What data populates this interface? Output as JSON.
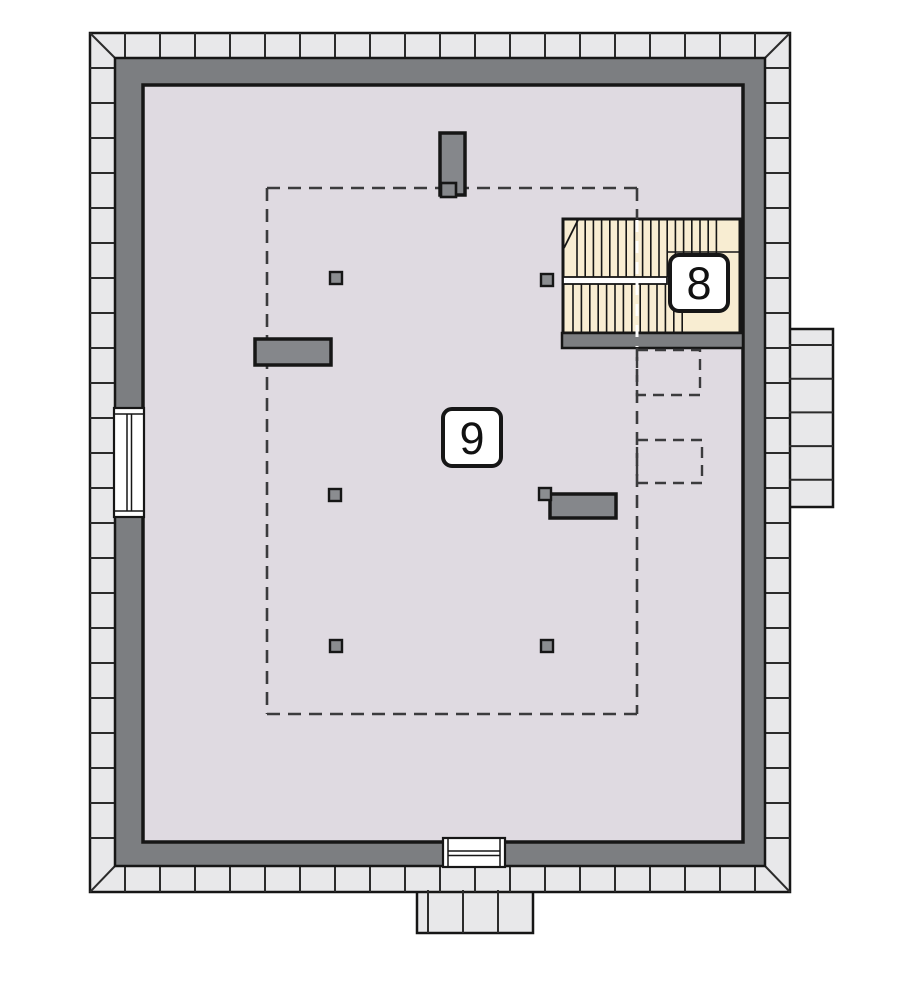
{
  "document": {
    "type": "architectural-floor-plan",
    "visible_text": [
      "9",
      "8"
    ]
  },
  "rooms": [
    {
      "number": "9",
      "area": "attic-main-room"
    },
    {
      "number": "8",
      "area": "staircase"
    }
  ],
  "colors": {
    "background": "#ffffff",
    "tile": "#e8e8ea",
    "wall": "#7c7e81",
    "floor": "#dfdae1",
    "stair": "#f8edd2",
    "chimney": "#85878b",
    "post": "#8b8d90",
    "line": "#161616",
    "tileline": "#2b2b2b",
    "dash": "#3b3b3d",
    "white": "#ffffff"
  },
  "plan": {
    "canvas": {
      "w": 900,
      "h": 999
    },
    "shapes": [
      {
        "name": "eaves-bump-right",
        "type": "rect",
        "x": 789,
        "y": 329,
        "w": 44,
        "h": 178,
        "fill": "tile",
        "stroke": "line",
        "sw": 2.5
      },
      {
        "name": "eaves-bump-bottom",
        "type": "rect",
        "x": 417,
        "y": 890,
        "w": 116,
        "h": 43,
        "fill": "tile",
        "stroke": "line",
        "sw": 2.5
      },
      {
        "name": "eaves-band",
        "type": "rect",
        "x": 90,
        "y": 33,
        "w": 700,
        "h": 859,
        "fill": "tile",
        "stroke": "line",
        "sw": 2.5
      },
      {
        "name": "tile-joints-top",
        "type": "run",
        "dir": "v",
        "from": 125,
        "to": 755,
        "step": 35,
        "a1": 33,
        "a2": 58,
        "stroke": "tileline",
        "sw": 2
      },
      {
        "name": "tile-joints-bottom",
        "type": "run",
        "dir": "v",
        "from": 125,
        "to": 755,
        "step": 35,
        "a1": 866,
        "a2": 892,
        "stroke": "tileline",
        "sw": 2
      },
      {
        "name": "tile-joints-left",
        "type": "run",
        "dir": "h",
        "from": 68,
        "to": 858,
        "step": 35,
        "a1": 90,
        "a2": 115,
        "stroke": "tileline",
        "sw": 2
      },
      {
        "name": "tile-joints-right",
        "type": "run",
        "dir": "h",
        "from": 68,
        "to": 858,
        "step": 35,
        "a1": 765,
        "a2": 790,
        "stroke": "tileline",
        "sw": 2
      },
      {
        "name": "tile-joints-right-bump",
        "type": "run",
        "dir": "h",
        "from": 345,
        "to": 480,
        "step": 33.7,
        "a1": 789,
        "a2": 833,
        "stroke": "tileline",
        "sw": 2
      },
      {
        "name": "tile-joints-bottom-bump",
        "type": "run",
        "dir": "v",
        "from": 428,
        "to": 498,
        "step": 35,
        "a1": 890,
        "a2": 933,
        "stroke": "tileline",
        "sw": 2
      },
      {
        "name": "corner-miter-top-left",
        "type": "line",
        "x1": 90,
        "y1": 33,
        "x2": 115,
        "y2": 58,
        "stroke": "tileline",
        "sw": 2
      },
      {
        "name": "corner-miter-top-right",
        "type": "line",
        "x1": 790,
        "y1": 33,
        "x2": 765,
        "y2": 58,
        "stroke": "tileline",
        "sw": 2
      },
      {
        "name": "corner-miter-bottom-left",
        "type": "line",
        "x1": 90,
        "y1": 892,
        "x2": 115,
        "y2": 866,
        "stroke": "tileline",
        "sw": 2
      },
      {
        "name": "corner-miter-bottom-right",
        "type": "line",
        "x1": 790,
        "y1": 892,
        "x2": 765,
        "y2": 866,
        "stroke": "tileline",
        "sw": 2
      },
      {
        "name": "exterior-wall",
        "type": "rect",
        "x": 115,
        "y": 58,
        "w": 650,
        "h": 808,
        "fill": "wall",
        "stroke": "line",
        "sw": 2.5
      },
      {
        "name": "attic-floor",
        "type": "rect",
        "x": 143,
        "y": 85,
        "w": 600,
        "h": 757,
        "fill": "floor",
        "stroke": "line",
        "sw": 3.5
      },
      {
        "name": "stair-area",
        "type": "rect",
        "x": 563,
        "y": 219,
        "w": 177,
        "h": 114,
        "fill": "stair",
        "stroke": "line",
        "sw": 3
      },
      {
        "name": "stair-treads-upper",
        "type": "run",
        "dir": "v",
        "from": 577,
        "to": 717,
        "step": 8.2,
        "a1": 220,
        "a2": 277,
        "stroke": "line",
        "sw": 1.6
      },
      {
        "name": "stair-treads-lower",
        "type": "run",
        "dir": "v",
        "from": 573,
        "to": 690,
        "step": 8.4,
        "a1": 284,
        "a2": 332,
        "stroke": "line",
        "sw": 1.6
      },
      {
        "name": "stair-landing-edge",
        "type": "line",
        "x1": 667,
        "y1": 252,
        "x2": 739,
        "y2": 252,
        "stroke": "line",
        "sw": 1.6
      },
      {
        "name": "stair-break-line",
        "type": "line",
        "x1": 578,
        "y1": 220,
        "x2": 564,
        "y2": 248,
        "stroke": "line",
        "sw": 1.8
      },
      {
        "name": "stair-handrail",
        "type": "rect",
        "x": 563,
        "y": 277,
        "w": 104,
        "h": 7,
        "fill": "white",
        "stroke": "line",
        "sw": 1.8
      },
      {
        "name": "stair-bottom-wall",
        "type": "rect",
        "x": 562,
        "y": 333,
        "w": 181,
        "h": 15,
        "fill": "wall",
        "stroke": "line",
        "sw": 2.5
      },
      {
        "name": "knee-wall-dash-top",
        "type": "line",
        "x1": 267,
        "y1": 188,
        "x2": 637,
        "y2": 188,
        "stroke": "dash",
        "sw": 2.6,
        "dash": "13 8"
      },
      {
        "name": "knee-wall-dash-left",
        "type": "line",
        "x1": 267,
        "y1": 188,
        "x2": 267,
        "y2": 714,
        "stroke": "dash",
        "sw": 2.6,
        "dash": "13 8"
      },
      {
        "name": "knee-wall-dash-bottom",
        "type": "line",
        "x1": 267,
        "y1": 714,
        "x2": 637,
        "y2": 714,
        "stroke": "dash",
        "sw": 2.6,
        "dash": "13 8"
      },
      {
        "name": "knee-wall-dash-right-a",
        "type": "line",
        "x1": 637,
        "y1": 188,
        "x2": 637,
        "y2": 219,
        "stroke": "dash",
        "sw": 2.6,
        "dash": "13 8"
      },
      {
        "name": "knee-wall-dash-right-b",
        "type": "line",
        "x1": 637,
        "y1": 348,
        "x2": 637,
        "y2": 714,
        "stroke": "dash",
        "sw": 2.6,
        "dash": "13 8"
      },
      {
        "name": "stair-dash-overlay",
        "type": "line",
        "x1": 637,
        "y1": 220,
        "x2": 637,
        "y2": 347,
        "stroke": "white",
        "sw": 3,
        "dash": "12 9"
      },
      {
        "name": "dashed-box-upper",
        "type": "rect",
        "x": 637,
        "y": 350,
        "w": 63,
        "h": 45,
        "fill": "none",
        "stroke": "dash",
        "sw": 2.4,
        "dash": "11 7"
      },
      {
        "name": "dashed-box-lower",
        "type": "rect",
        "x": 637,
        "y": 440,
        "w": 65,
        "h": 43,
        "fill": "none",
        "stroke": "dash",
        "sw": 2.4,
        "dash": "11 7"
      },
      {
        "name": "chimney-top",
        "type": "rect",
        "x": 440,
        "y": 133,
        "w": 25,
        "h": 62,
        "fill": "chimney",
        "stroke": "line",
        "sw": 3.5
      },
      {
        "name": "chimney-top-flue",
        "type": "rect",
        "x": 441,
        "y": 183,
        "w": 15,
        "h": 14,
        "fill": "chimney",
        "stroke": "line",
        "sw": 2.6
      },
      {
        "name": "chimney-left",
        "type": "rect",
        "x": 255,
        "y": 339,
        "w": 76,
        "h": 26,
        "fill": "chimney",
        "stroke": "line",
        "sw": 3.5
      },
      {
        "name": "chimney-right",
        "type": "rect",
        "x": 550,
        "y": 494,
        "w": 66,
        "h": 24,
        "fill": "chimney",
        "stroke": "line",
        "sw": 3.5
      },
      {
        "name": "post-top-left",
        "type": "rect",
        "x": 330,
        "y": 272,
        "w": 12,
        "h": 12,
        "fill": "post",
        "stroke": "line",
        "sw": 2.4
      },
      {
        "name": "post-top-right",
        "type": "rect",
        "x": 541,
        "y": 274,
        "w": 12,
        "h": 12,
        "fill": "post",
        "stroke": "line",
        "sw": 2.4
      },
      {
        "name": "post-mid-left",
        "type": "rect",
        "x": 329,
        "y": 489,
        "w": 12,
        "h": 12,
        "fill": "post",
        "stroke": "line",
        "sw": 2.4
      },
      {
        "name": "post-mid-right",
        "type": "rect",
        "x": 539,
        "y": 488,
        "w": 12,
        "h": 12,
        "fill": "post",
        "stroke": "line",
        "sw": 2.4
      },
      {
        "name": "post-bottom-left",
        "type": "rect",
        "x": 330,
        "y": 640,
        "w": 12,
        "h": 12,
        "fill": "post",
        "stroke": "line",
        "sw": 2.4
      },
      {
        "name": "post-bottom-right",
        "type": "rect",
        "x": 541,
        "y": 640,
        "w": 12,
        "h": 12,
        "fill": "post",
        "stroke": "line",
        "sw": 2.4
      },
      {
        "name": "window-left",
        "type": "rect",
        "x": 114,
        "y": 408,
        "w": 30,
        "h": 109,
        "fill": "white",
        "stroke": "line",
        "sw": 2.2
      },
      {
        "name": "window-left-frame-top",
        "type": "line",
        "x1": 114,
        "y1": 414,
        "x2": 144,
        "y2": 414,
        "stroke": "line",
        "sw": 1.5
      },
      {
        "name": "window-left-frame-bottom",
        "type": "line",
        "x1": 114,
        "y1": 511,
        "x2": 144,
        "y2": 511,
        "stroke": "line",
        "sw": 1.5
      },
      {
        "name": "window-left-glass-a",
        "type": "line",
        "x1": 127,
        "y1": 414,
        "x2": 127,
        "y2": 511,
        "stroke": "line",
        "sw": 1.5
      },
      {
        "name": "window-left-glass-b",
        "type": "line",
        "x1": 131.5,
        "y1": 414,
        "x2": 131.5,
        "y2": 511,
        "stroke": "line",
        "sw": 1.5
      },
      {
        "name": "window-bottom",
        "type": "rect",
        "x": 443,
        "y": 838,
        "w": 62,
        "h": 29,
        "fill": "white",
        "stroke": "line",
        "sw": 2.2
      },
      {
        "name": "window-bottom-frame-left",
        "type": "line",
        "x1": 448,
        "y1": 838,
        "x2": 448,
        "y2": 867,
        "stroke": "line",
        "sw": 1.5
      },
      {
        "name": "window-bottom-frame-right",
        "type": "line",
        "x1": 500,
        "y1": 838,
        "x2": 500,
        "y2": 867,
        "stroke": "line",
        "sw": 1.5
      },
      {
        "name": "window-bottom-glass-a",
        "type": "line",
        "x1": 448,
        "y1": 851,
        "x2": 500,
        "y2": 851,
        "stroke": "line",
        "sw": 1.5
      },
      {
        "name": "window-bottom-glass-b",
        "type": "line",
        "x1": 448,
        "y1": 855.5,
        "x2": 500,
        "y2": 855.5,
        "stroke": "line",
        "sw": 1.5
      }
    ]
  }
}
